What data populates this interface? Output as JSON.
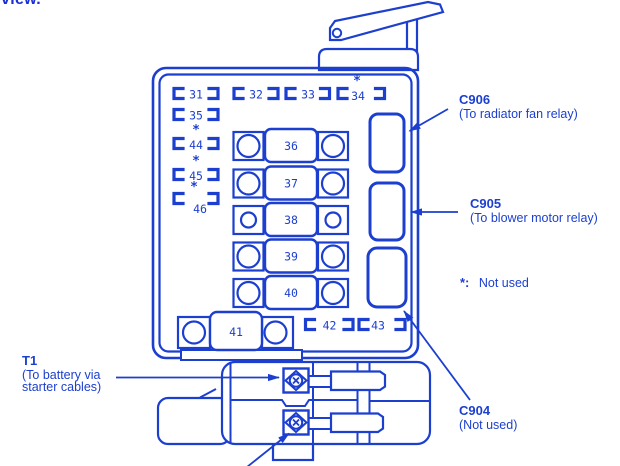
{
  "page": {
    "corner_text": "view."
  },
  "colors": {
    "ink_blue": "#1c3fcf",
    "background": "#ffffff"
  },
  "fuse_box": {
    "bracket_fuses": [
      {
        "number": "31",
        "star": ""
      },
      {
        "number": "32",
        "star": ""
      },
      {
        "number": "33",
        "star": ""
      },
      {
        "number": "34",
        "star": "*"
      },
      {
        "number": "35",
        "star": ""
      },
      {
        "number": "44",
        "star": "*"
      },
      {
        "number": "45",
        "star": "*"
      },
      {
        "number": "46",
        "star": "*"
      },
      {
        "number": "42",
        "star": ""
      },
      {
        "number": "43",
        "star": ""
      }
    ],
    "cartridge_fuses": [
      {
        "number": "36"
      },
      {
        "number": "37"
      },
      {
        "number": "38"
      },
      {
        "number": "39"
      },
      {
        "number": "40"
      },
      {
        "number": "41"
      }
    ]
  },
  "callouts": {
    "c906": {
      "code": "C906",
      "description": "(To radiator fan relay)"
    },
    "c905": {
      "code": "C905",
      "description": "(To blower motor relay)"
    },
    "c904": {
      "code": "C904",
      "description": "(Not used)"
    },
    "t1": {
      "code": "T1",
      "description_line1": "(To battery via",
      "description_line2": "starter cables)"
    }
  },
  "legend": {
    "prefix": "*:",
    "text": "Not used"
  }
}
